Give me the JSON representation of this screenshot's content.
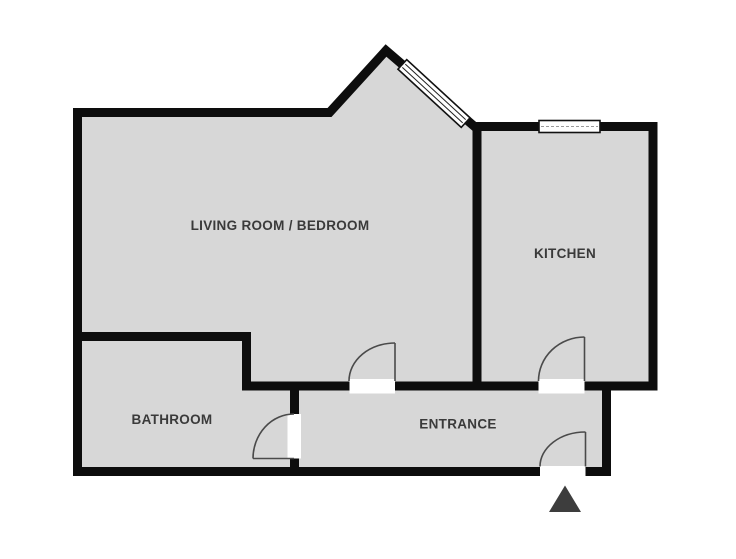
{
  "plan": {
    "type": "apartment-floor-plan",
    "rooms": [
      {
        "id": "living-room-bedroom",
        "label": "LIVING ROOM / BEDROOM"
      },
      {
        "id": "kitchen",
        "label": "KITCHEN"
      },
      {
        "id": "bathroom",
        "label": "BATHROOM"
      },
      {
        "id": "entrance",
        "label": "ENTRANCE"
      }
    ],
    "features": {
      "windows": [
        "slanted-bay-window-living-room",
        "kitchen-top-window"
      ],
      "doors": [
        "living-room-door",
        "kitchen-door",
        "bathroom-door",
        "entrance-front-door"
      ],
      "entrance_marker": "entrance-arrow"
    },
    "colors": {
      "wall": "#0d0d0d",
      "floor": "#d7d7d7",
      "label_text": "#3a3a3a",
      "door_arc": "#4a4a4a",
      "window_fill": "#ffffff",
      "entrance_arrow": "#3d3d3d",
      "background": "#ffffff"
    }
  }
}
